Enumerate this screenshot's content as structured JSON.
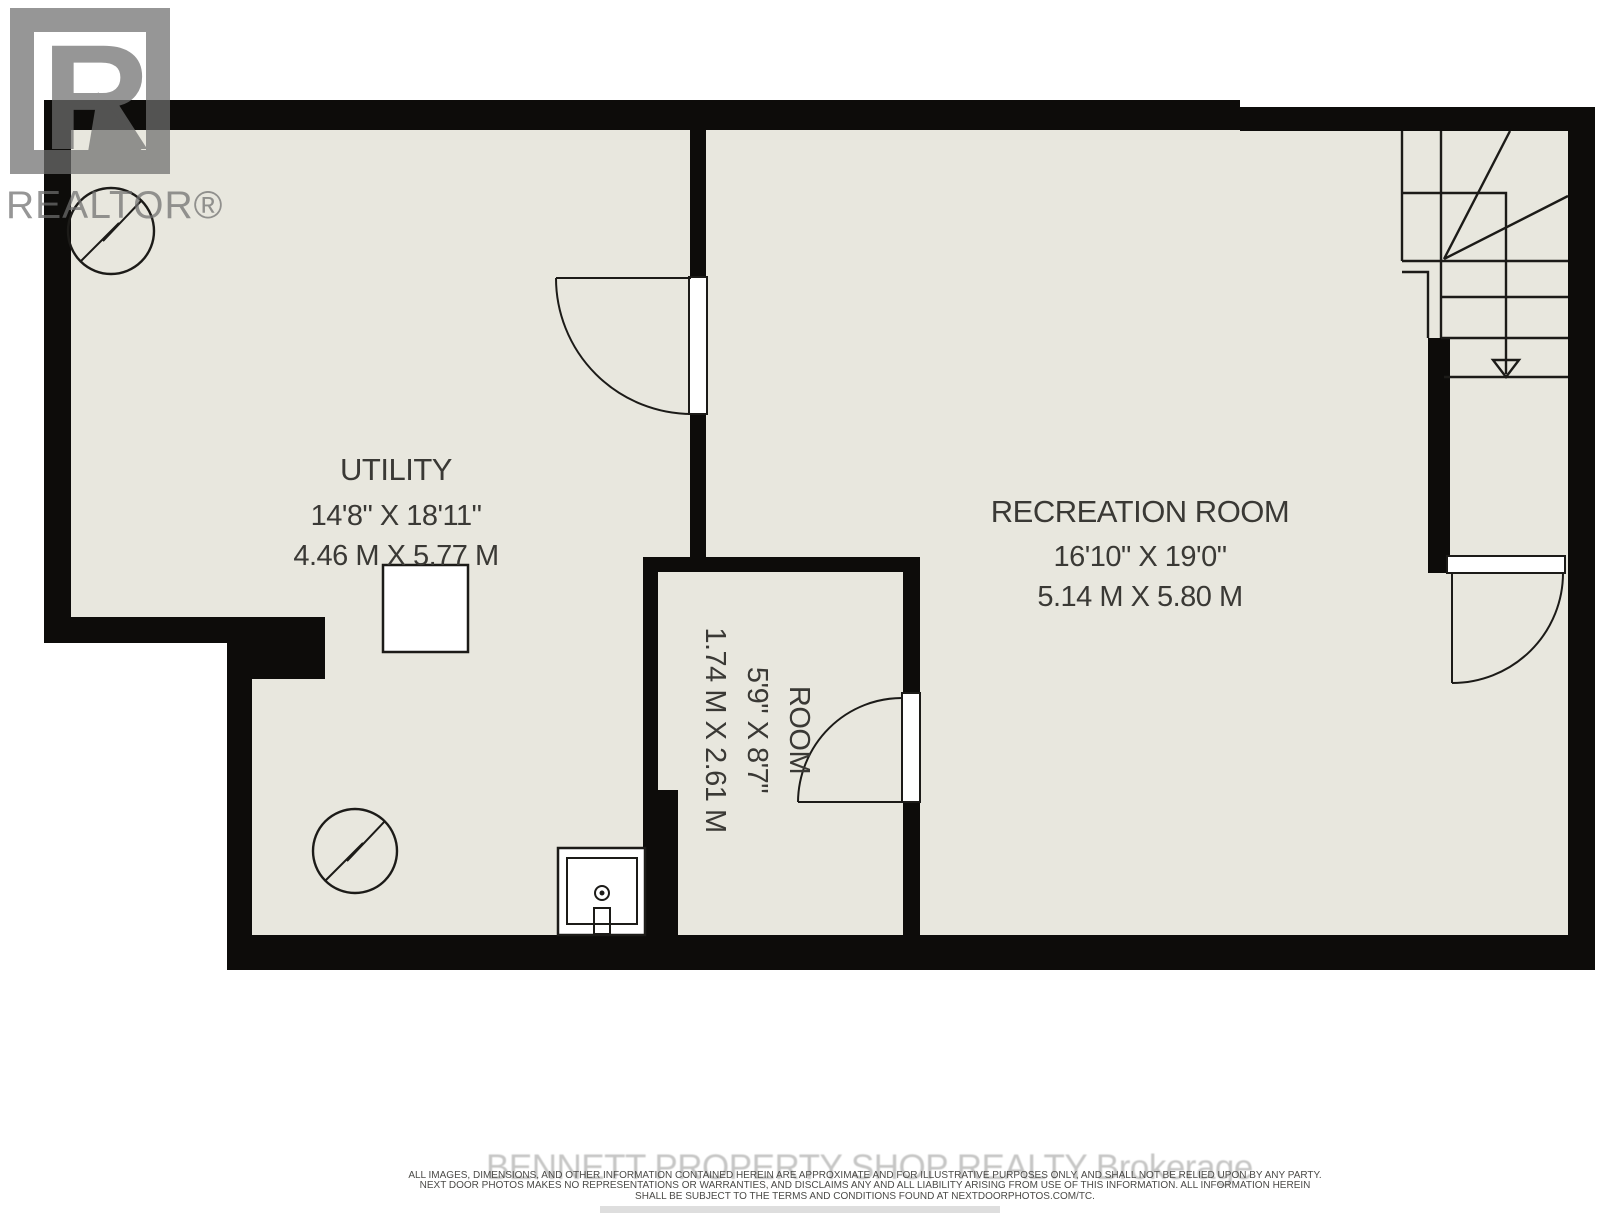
{
  "title": "Basement floor plan",
  "rooms": [
    {
      "name": "UTILITY",
      "imperial": "14'8\" X 18'11\"",
      "metric": "4.46 M X 5.77 M"
    },
    {
      "name": "RECREATION ROOM",
      "imperial": "16'10\" X 19'0\"",
      "metric": "5.14 M X 5.80 M"
    },
    {
      "name": "ROOM",
      "imperial": "5'9\" X 8'7\"",
      "metric": "1.74 M X 2.61 M"
    }
  ],
  "logo": {
    "letter": "R",
    "label": "REALTOR®"
  },
  "watermark": "BENNETT PROPERTY SHOP REALTY  Brokerage",
  "disclaimer": {
    "lines": [
      "ALL IMAGES, DIMENSIONS, AND OTHER INFORMATION CONTAINED HEREIN ARE APPROXIMATE AND FOR ILLUSTRATIVE PURPOSES ONLY, AND SHALL NOT BE RELIED UPON BY ANY PARTY.",
      "NEXT DOOR PHOTOS MAKES NO REPRESENTATIONS OR WARRANTIES, AND DISCLAIMS ANY AND ALL LIABILITY ARISING FROM USE OF THIS INFORMATION. ALL INFORMATION HEREIN",
      "SHALL BE SUBJECT TO THE TERMS AND CONDITIONS FOUND AT NEXTDOORPHOTOS.COM/TC."
    ]
  },
  "symbols": {
    "electrical": "circle-lightning-bolt",
    "stairs_direction": "down",
    "sink": "laundry-sink",
    "furnace": "furnace-box"
  },
  "colors": {
    "floor": "#e8e7de",
    "wall": "#0d0c0a",
    "line": "#1c1b18",
    "text": "#3a3935",
    "watermark": "#c6c6c5",
    "logo": "#6f6f6f",
    "disclaimer": "#4b4a47",
    "paper": "#ffffff"
  }
}
